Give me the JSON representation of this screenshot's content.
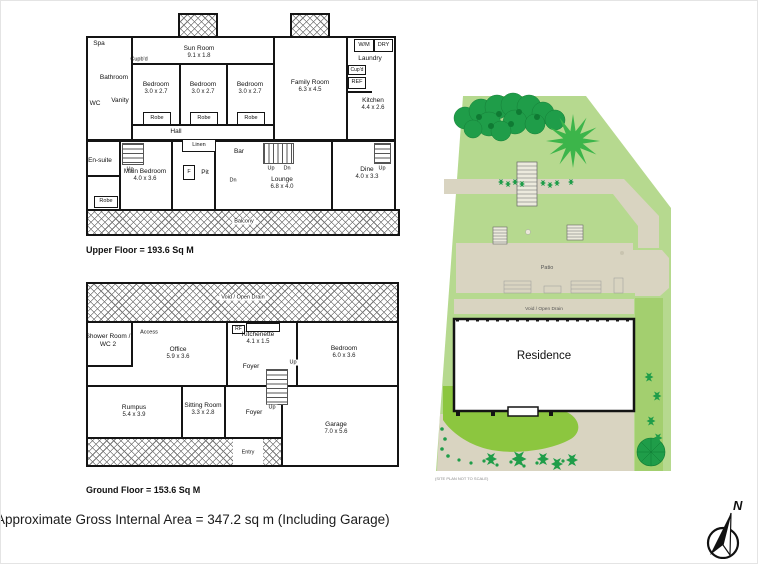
{
  "footer": {
    "area_note": "Approximate Gross Internal Area = 347.2 sq m (Including Garage)"
  },
  "compass": {
    "north_label": "N"
  },
  "plans": {
    "upper": {
      "caption": "Upper Floor = 193.6 Sq M",
      "labels": {
        "spa": "Spa",
        "bathroom": "Bathroom",
        "wc": "WC",
        "vanity": "Vanity",
        "cupbd": "Cupb'd",
        "sunroom": "Sun Room",
        "sunroom_dims": "9.1 x 1.8",
        "bedroom": "Bedroom",
        "bedroom_dims": "3.0 x 2.7",
        "robe": "Robe",
        "family": "Family Room",
        "family_dims": "6.3 x 4.5",
        "wm": "W/M",
        "dry": "DRY",
        "laundry": "Laundry",
        "cupd": "Cup'd",
        "ref": "REF",
        "kitchen": "Kitchen",
        "kitchen_dims": "4.4 x 2.6",
        "hall": "Hall",
        "linen": "Linen",
        "ensuite": "En-suite",
        "main_bedroom": "Main Bedroom",
        "main_bedroom_dims": "4.0 x 3.6",
        "f": "F",
        "pit": "Pit",
        "bar": "Bar",
        "lounge": "Lounge",
        "lounge_dims": "6.8 x 4.0",
        "dine": "Dine",
        "dine_dims": "4.0 x 3.3",
        "up": "Up",
        "dn": "Dn",
        "balcony": "Balcony"
      }
    },
    "ground": {
      "caption": "Ground Floor = 153.6 Sq M",
      "labels": {
        "void": "Void / Open Drain",
        "shower1": "Shower Room /",
        "shower2": "WC 2",
        "access": "Access",
        "office": "Office",
        "office_dims": "5.9 x 3.6",
        "rf": "RF",
        "kitchenette": "Kitchenette",
        "kitchenette_dims": "4.1 x 1.5",
        "foyer": "Foyer",
        "up": "Up",
        "bedroom": "Bedroom",
        "bedroom_dims": "6.0 x 3.6",
        "rumpus": "Rumpus",
        "rumpus_dims": "5.4 x 3.9",
        "sitting": "Sitting Room",
        "sitting_dims": "3.3 x 2.8",
        "garage": "Garage",
        "garage_dims": "7.0 x 5.6",
        "entry": "Entry"
      }
    }
  },
  "site": {
    "patio_label": "Patio",
    "void_label": "Void / Open Drain",
    "residence_label": "Residence",
    "note": "(SITE PLAN NOT TO SCALE)",
    "colors": {
      "lawn": "#b6d98f",
      "garden": "#8cc63f",
      "tree_dark": "#1f9d49",
      "tree_bright": "#3cb54a",
      "path": "#d9d4c1",
      "strip": "#a3cf6f"
    }
  }
}
